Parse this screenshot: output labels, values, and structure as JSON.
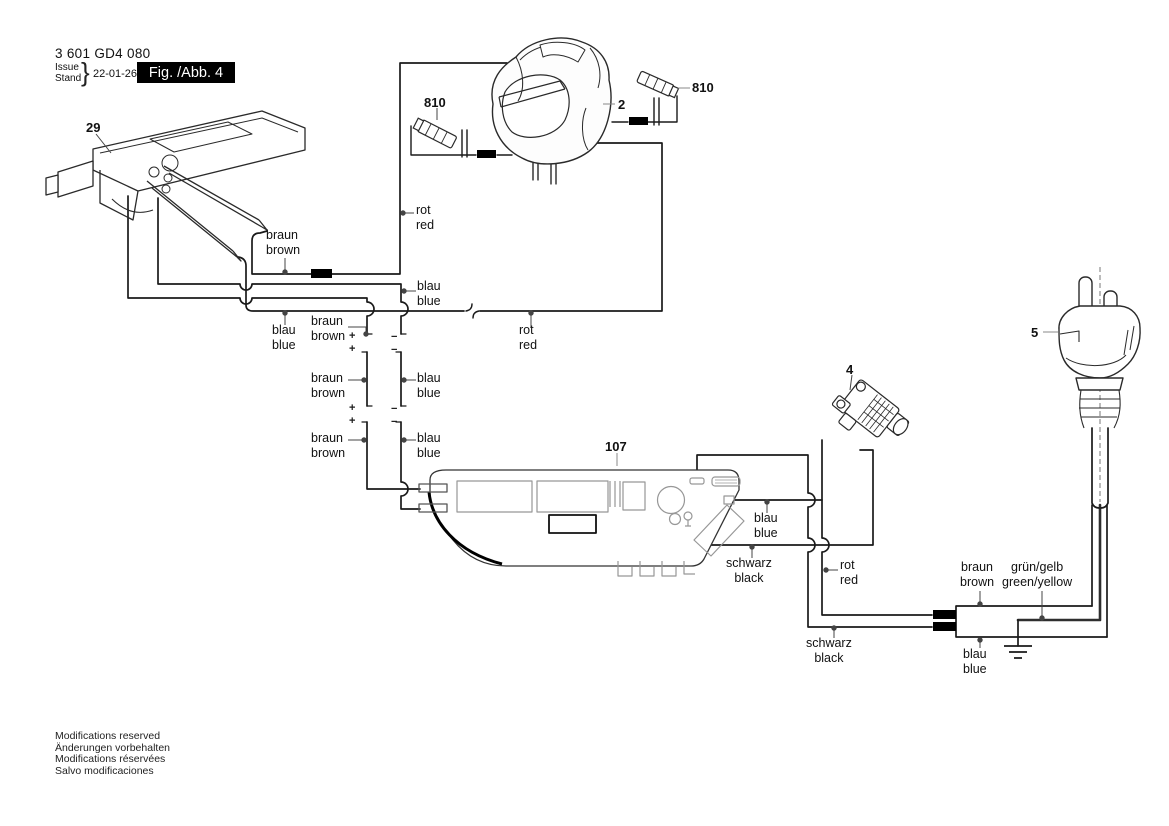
{
  "header": {
    "part_number": "3 601 GD4 080",
    "issue_label": "Issue",
    "stand_label": "Stand",
    "brace": "}",
    "date": "22-01-26",
    "figure_label": "Fig. /Abb. 4"
  },
  "part_labels": [
    {
      "label": "29",
      "x": 86,
      "y": 120
    },
    {
      "label": "810",
      "x": 424,
      "y": 95
    },
    {
      "label": "2",
      "x": 618,
      "y": 97
    },
    {
      "label": "810",
      "x": 692,
      "y": 80
    },
    {
      "label": "5",
      "x": 1031,
      "y": 325
    },
    {
      "label": "4",
      "x": 846,
      "y": 362
    },
    {
      "label": "107",
      "x": 605,
      "y": 439
    }
  ],
  "wire_labels": [
    {
      "de": "rot",
      "en": "red",
      "x": 416,
      "y": 203,
      "align": "left"
    },
    {
      "de": "braun",
      "en": "brown",
      "x": 266,
      "y": 228,
      "align": "left"
    },
    {
      "de": "blau",
      "en": "blue",
      "x": 417,
      "y": 279,
      "align": "left"
    },
    {
      "de": "blau",
      "en": "blue",
      "x": 272,
      "y": 323,
      "align": "left"
    },
    {
      "de": "braun",
      "en": "brown",
      "x": 311,
      "y": 314,
      "align": "left"
    },
    {
      "de": "rot",
      "en": "red",
      "x": 519,
      "y": 323,
      "align": "left"
    },
    {
      "de": "braun",
      "en": "brown",
      "x": 311,
      "y": 371,
      "align": "left"
    },
    {
      "de": "blau",
      "en": "blue",
      "x": 417,
      "y": 371,
      "align": "left"
    },
    {
      "de": "braun",
      "en": "brown",
      "x": 311,
      "y": 431,
      "align": "left"
    },
    {
      "de": "blau",
      "en": "blue",
      "x": 417,
      "y": 431,
      "align": "left"
    },
    {
      "de": "blau",
      "en": "blue",
      "x": 754,
      "y": 511,
      "align": "left"
    },
    {
      "de": "schwarz",
      "en": "black",
      "x": 726,
      "y": 556,
      "align": "center"
    },
    {
      "de": "rot",
      "en": "red",
      "x": 840,
      "y": 558,
      "align": "left"
    },
    {
      "de": "schwarz",
      "en": "black",
      "x": 806,
      "y": 636,
      "align": "center"
    },
    {
      "de": "braun",
      "en": "brown",
      "x": 960,
      "y": 560,
      "align": "center"
    },
    {
      "de": "grün/gelb",
      "en": "green/yellow",
      "x": 1002,
      "y": 560,
      "align": "center"
    },
    {
      "de": "blau",
      "en": "blue",
      "x": 963,
      "y": 647,
      "align": "center"
    }
  ],
  "polarity_marks": [
    {
      "t": "+",
      "x": 349,
      "y": 330
    },
    {
      "t": "−",
      "x": 391,
      "y": 331
    },
    {
      "t": "+",
      "x": 349,
      "y": 343
    },
    {
      "t": "−",
      "x": 391,
      "y": 344
    },
    {
      "t": "+",
      "x": 349,
      "y": 402
    },
    {
      "t": "−",
      "x": 391,
      "y": 403
    },
    {
      "t": "+",
      "x": 349,
      "y": 415
    },
    {
      "t": "−",
      "x": 391,
      "y": 416
    }
  ],
  "footer": {
    "lines": [
      "Modifications reserved",
      "Änderungen vorbehalten",
      "Modifications réservées",
      "Salvo modificaciones"
    ]
  },
  "colors": {
    "line": "#1a1a1a",
    "accent_black": "#000000",
    "detail_gray": "#8a8a8a"
  }
}
